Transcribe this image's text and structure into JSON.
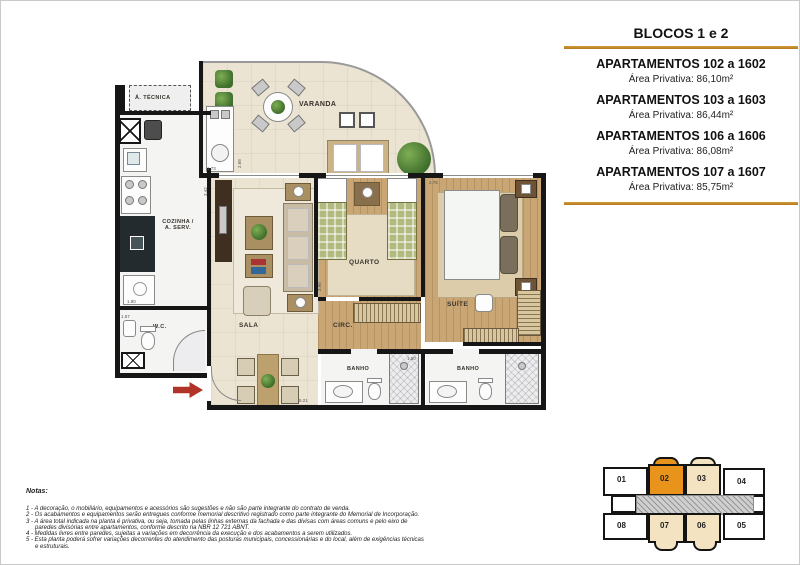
{
  "legend": {
    "title": "BLOCOS 1 e 2",
    "accent_color": "#b5791a",
    "apartments": [
      {
        "name": "APARTAMENTOS 102 a 1602",
        "area": "Área Privativa: 86,10m²"
      },
      {
        "name": "APARTAMENTOS 103 a 1603",
        "area": "Área Privativa: 86,44m²"
      },
      {
        "name": "APARTAMENTOS 106 a 1606",
        "area": "Área Privativa: 86,08m²"
      },
      {
        "name": "APARTAMENTOS 107 a 1607",
        "area": "Área Privativa: 85,75m²"
      }
    ]
  },
  "floorplan": {
    "rooms": {
      "varanda": "VARANDA",
      "tecnica": "Á. TÉCNICA",
      "cozinha_l1": "COZINHA /",
      "cozinha_l2": "A. SERV.",
      "wc": "W.C.",
      "sala": "SALA",
      "circ": "CIRC.",
      "quarto": "QUARTO",
      "suite": "SUÍTE",
      "banho1": "BANHO",
      "banho2": "BANHO"
    },
    "dims": [
      "1.73",
      "2.68",
      "3.42",
      "1.80",
      "1.67",
      "5.21",
      "1.50",
      "2.76",
      "2.90"
    ]
  },
  "notes": {
    "heading": "Notas:",
    "items": [
      "1 - A decoração, o mobiliário, equipamentos e acessórios são sugestões e não são parte integrante do contrato de venda.",
      "2 - Os acabamentos e equipamentos serão entregues conforme memorial descritivo registrado como parte integrante do Memorial de Incorporação.",
      "3 - A área total indicada na planta é privativa, ou seja, tomada pelas linhas externas da fachada e das divisas com áreas comuns e pelo eixo de paredes divisórias entre apartamentos, conforme descrito na NBR 12 721 ABNT.",
      "4 - Medidas livres entre paredes, sujeitas a variações em decorrência da execução e dos acabamentos a serem utilizados.",
      "5 - Esta planta poderá sofrer variações decorrentes do atendimento das posturas municipais, concessionárias e do local, além de exigências técnicas e estruturais."
    ]
  },
  "keyplan": {
    "highlight_color": "#e8941c",
    "beige_color": "#f3e3c0",
    "units": [
      "01",
      "02",
      "03",
      "04",
      "05",
      "06",
      "07",
      "08"
    ]
  }
}
